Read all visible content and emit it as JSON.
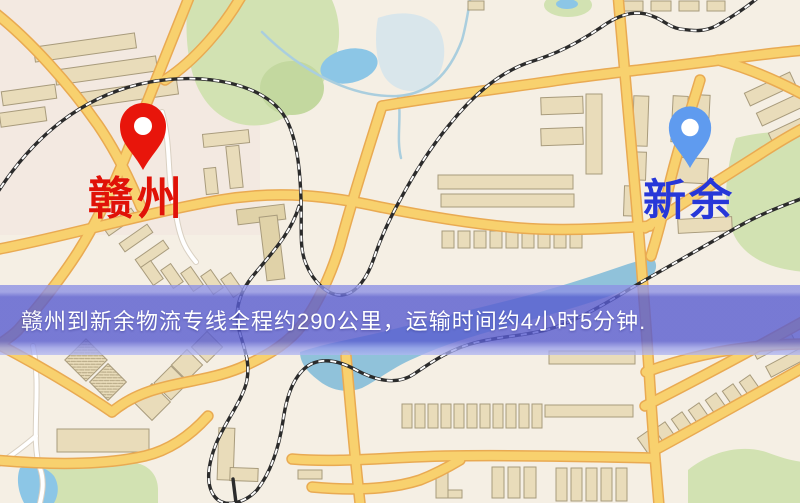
{
  "markers": {
    "origin": {
      "label": "赣州",
      "label_color": "#e01208",
      "pin_color": "#e8150b"
    },
    "destination": {
      "label": "新余",
      "label_color": "#2737d8",
      "pin_color": "#5f9bef"
    }
  },
  "banner": {
    "text": "赣州到新余物流专线全程约290公里，运输时间约4小时5分钟.",
    "background_color": "#585cd0",
    "text_color": "#ffffff"
  },
  "map_colors": {
    "background": "#f5efe4",
    "road": "#f8d16e",
    "road_casing": "#e9aa52",
    "building": "#e9dcba",
    "park": "#d2e2b2",
    "water": "#8cc6e6",
    "railway": "#2b2b2b"
  }
}
